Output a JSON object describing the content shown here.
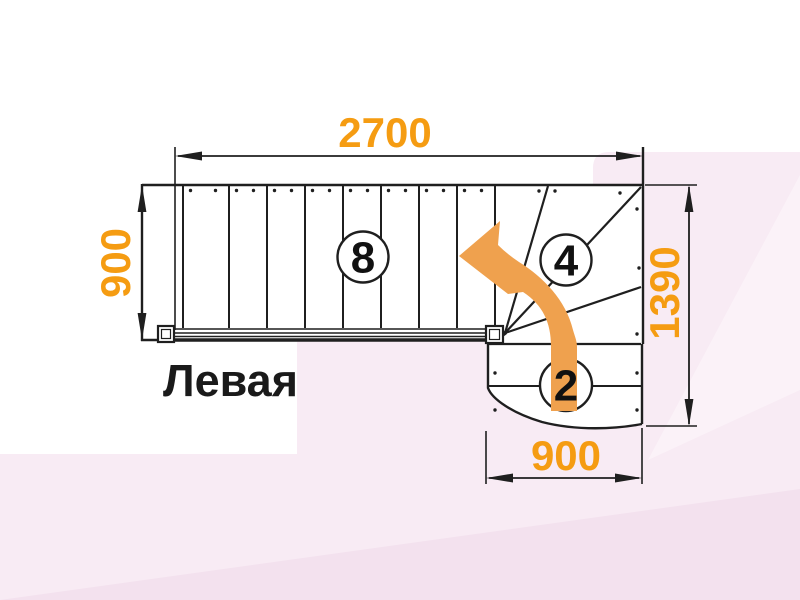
{
  "title": "Левая",
  "dimensions": {
    "top": "2700",
    "left": "900",
    "right": "1390",
    "bottom": "900"
  },
  "steps": {
    "straight_flight_count": "8",
    "winder_count": "4",
    "lower_flight_count": "2"
  },
  "colors": {
    "dimension_text": "#F59C12",
    "arrow": "#EFA14E",
    "line": "#1F1F1F",
    "title_text": "#1A1A1A",
    "bg_pink": "#F8EBF4",
    "bg_pink_dark": "#F3E1EE",
    "bg_pink_light": "#FBF2F8"
  }
}
